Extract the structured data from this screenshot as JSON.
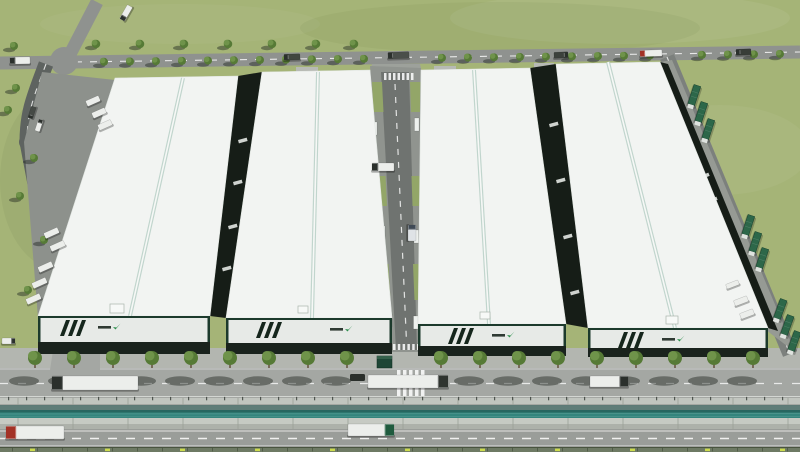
{
  "meta": {
    "description": "Aerial 3D rendering of an industrial park: four white-roofed warehouses in a row, central service corridor, perimeter roads with trucks and trees, front canal and outer highway"
  },
  "palette": {
    "grass": "#a5b477",
    "roadTop": "#8f928f",
    "roadLeft": "#5e6360",
    "roadRight": "#7c807d",
    "roadCorridor": "#6f7370",
    "apron": "#b3b6b0",
    "innerRoad": "#a4a7a3",
    "outerRoad": "#9a9d99",
    "pad": "#b7bab4",
    "campusApron": "#8d918c",
    "rightApron": "#969a94",
    "wallTop": "#c1c5bf",
    "wallShadow": "#5f7d78",
    "water": "#33857d",
    "waterDark": "#276660",
    "nearWall": "#c6cac3",
    "wallFace": "#adb1aa",
    "hedge": "#6e7a64",
    "hedgeDot": "#ccdb4e",
    "roof": "#f2f4f2",
    "roofEdge": "#e0e5e1",
    "ridge": "#bcd2ca",
    "facade": "#e7eae7",
    "facadeBase": "#1a231d",
    "accent": "#1c3a2c",
    "stripe": "#15261c",
    "gapDark": "#161d17",
    "corridorGrass": "#93a668",
    "treeCrown": "#567a36",
    "treeLight": "#6f934a",
    "trunk": "#5d4a33",
    "truckWhite": "#eceeeb",
    "cabDark": "#2b302c",
    "cabRed": "#a33226",
    "cabGreen": "#1f5b3e",
    "container": "#2d6749",
    "mark": "#2f8f4e",
    "shadow": "rgba(30,38,32,0.45)"
  },
  "scene": {
    "mottles": [
      [
        620,
        18,
        170,
        26,
        "rgba(255,255,255,0.06)"
      ],
      [
        180,
        24,
        140,
        20,
        "rgba(255,255,255,0.04)"
      ],
      [
        500,
        28,
        200,
        26,
        "rgba(110,125,70,0.10)"
      ],
      [
        720,
        150,
        90,
        45,
        "rgba(255,255,255,0.05)"
      ],
      [
        60,
        180,
        60,
        90,
        "rgba(45,65,30,0.06)"
      ]
    ],
    "bands": [
      {
        "name": "front-apron",
        "y": 348,
        "h": 20,
        "c": "$apron"
      },
      {
        "name": "inner-road",
        "y": 368,
        "h": 30,
        "c": "$innerRoad"
      },
      {
        "name": "canal-wall-top",
        "y": 398,
        "h": 7,
        "c": "$wallTop"
      },
      {
        "name": "canal-wall-shade",
        "y": 405,
        "h": 5,
        "c": "$wallShadow"
      },
      {
        "name": "canal-water",
        "y": 410,
        "h": 8,
        "c": "$water"
      },
      {
        "name": "canal-near-wall",
        "y": 418,
        "h": 6,
        "c": "$nearWall"
      },
      {
        "name": "canal-wall-face",
        "y": 424,
        "h": 5,
        "c": "$wallFace"
      },
      {
        "name": "outer-road",
        "y": 429,
        "h": 18,
        "c": "$outerRoad"
      },
      {
        "name": "perimeter-hedge",
        "y": 447,
        "h": 5,
        "c": "$hedge"
      }
    ],
    "lane_marks": [
      {
        "y": 369,
        "dash": "",
        "w": 1,
        "c": "#ffffff",
        "o": 0.45
      },
      {
        "y": 383.5,
        "dash": "8 10",
        "w": 1.3,
        "c": "#ffffff",
        "o": 0.75
      },
      {
        "y": 396.5,
        "dash": "",
        "w": 1,
        "c": "#e8ebe7",
        "o": 0.7
      },
      {
        "y": 431,
        "dash": "",
        "w": 1,
        "c": "#ffffff",
        "o": 0.7
      },
      {
        "y": 438.5,
        "dash": "9 9",
        "w": 1.4,
        "c": "#ffffff",
        "o": 0.85
      },
      {
        "y": 445.7,
        "dash": "",
        "w": 0.8,
        "c": "#ffffff",
        "o": 0.45
      }
    ],
    "roads": {
      "top": {
        "d": "M0,63 L800,52",
        "w": 13,
        "c": "$roadTop",
        "dash": "7 8"
      },
      "top_arm": {
        "d": "M97,2 L67,60",
        "w": 13,
        "c": "$roadTop",
        "dash": ""
      },
      "left_arm": {
        "d": "M0,64 L62,62",
        "w": 11,
        "c": "$roadTop",
        "dash": ""
      },
      "left": {
        "d": "M46,64 C34,96 27,112 27,142 L66,346",
        "w": 15,
        "c": "$roadLeft",
        "dash": "6 7"
      },
      "right": {
        "d": "M667,57 L790,354",
        "w": 15,
        "c": "$roadRight",
        "dash": "6 7"
      },
      "intersection": [
        64,
        61,
        14
      ]
    },
    "aprons": [
      {
        "name": "warehouse-1-west-apron",
        "pts": "42,72 115,80 38,318 24,142",
        "c": "$campusApron"
      },
      {
        "name": "warehouse-4-east-apron",
        "pts": "660,62 672,60 795,352 766,330",
        "c": "$rightApron"
      },
      {
        "name": "corridor-top-apron",
        "pts": "372,64 420,64 424,82 368,82",
        "c": "#9da19b"
      },
      {
        "name": "left-junction-pad",
        "pts": "54,344 100,344 100,370 50,370",
        "c": "$innerRoad"
      }
    ],
    "pads": [
      [
        296,
        67,
        22,
        8
      ],
      [
        434,
        66,
        22,
        8
      ],
      [
        534,
        63,
        20,
        9
      ],
      [
        600,
        66,
        36,
        10
      ]
    ],
    "corridor": {
      "apron": "370,66 421,68 418,352 392,352",
      "road": "381,72 409,72 417,350 396,350",
      "grass": [
        "372,82 382,82 383.5,112 373.5,112",
        "410,82 420.3,82 419.9,112 411,112",
        "375.5,176 385.5,176 387,206 377,206",
        "411.5,176 420,176 419.8,206 412.5,206",
        "379,264 388.5,264 390.5,300 381.5,300",
        "413,264 419.7,264 419.5,300 414.5,300"
      ],
      "dash": [
        395,
        84,
        406.5,
        342
      ],
      "canopies": [
        [
          372.5,
          122
        ],
        [
          380.5,
          226
        ],
        [
          387.5,
          314
        ],
        [
          414.5,
          118
        ],
        [
          414,
          230
        ],
        [
          413.5,
          316
        ]
      ],
      "zebra_top": {
        "x": 384,
        "y": 73,
        "n": 7,
        "dx": 4.5,
        "w": 2.5,
        "h": 7
      },
      "zebra_bottom": {
        "x": 393,
        "y": 344,
        "n": 6,
        "dx": 4.8,
        "w": 2.5,
        "h": 6
      }
    },
    "gaps": [
      {
        "name": "dock-strip-1-2",
        "pts": "210,316 226,318 262,72 238,76",
        "rot": -15,
        "slivers": [
          [
            238,
            140
          ],
          [
            233,
            182
          ],
          [
            228,
            226
          ],
          [
            222,
            268
          ]
        ]
      },
      {
        "name": "dock-strip-3-4",
        "pts": "566,324 588,328 556,64 530,68",
        "rot": -15,
        "slivers": [
          [
            549,
            124
          ],
          [
            556,
            180
          ],
          [
            563,
            236
          ],
          [
            570,
            292
          ]
        ]
      },
      {
        "name": "dock-strip-4-east",
        "pts": "768,328 778,331 668,64 660,62",
        "rot": -22,
        "slivers": [
          [
            700,
            176
          ],
          [
            708,
            200
          ],
          [
            736,
            298
          ],
          [
            743,
            312
          ]
        ]
      }
    ],
    "buildings": [
      {
        "id": "warehouse-1",
        "roof": "38,316 210,316 238,76 115,78",
        "ridge": [
          130,
          316,
          183,
          78
        ],
        "facade": {
          "x": 38,
          "y": 316,
          "w": 172,
          "h": 28
        },
        "base_h": 10,
        "stripes_x": 60,
        "logo_x": 98,
        "unit": [
          110,
          304,
          14,
          9
        ]
      },
      {
        "id": "warehouse-2",
        "roof": "226,318 392,318 370,70 262,72",
        "ridge": [
          312,
          318,
          318,
          72
        ],
        "facade": {
          "x": 226,
          "y": 318,
          "w": 166,
          "h": 27
        },
        "base_h": 9,
        "stripes_x": 256,
        "logo_x": 330,
        "unit": [
          298,
          306,
          10,
          7
        ]
      },
      {
        "id": "warehouse-3",
        "roof": "418,324 566,324 530,68 421,70",
        "ridge": [
          489,
          324,
          474,
          70
        ],
        "facade": {
          "x": 418,
          "y": 324,
          "w": 148,
          "h": 24
        },
        "base_h": 8,
        "stripes_x": 448,
        "logo_x": 492,
        "unit": [
          480,
          312,
          10,
          7
        ]
      },
      {
        "id": "warehouse-4",
        "roof": "588,328 768,328 660,62 556,64",
        "ridge": [
          675,
          328,
          608,
          62
        ],
        "facade": {
          "x": 588,
          "y": 328,
          "w": 180,
          "h": 22
        },
        "base_h": 7,
        "stripes_x": 618,
        "logo_x": 662,
        "unit": [
          666,
          316,
          12,
          8
        ]
      }
    ],
    "gate": {
      "house": [
        377,
        356,
        15,
        12
      ],
      "car": [
        350,
        374,
        15,
        7
      ],
      "zebra": {
        "x": 397,
        "y": 370,
        "n": 5,
        "dx": 6,
        "w": 3.5,
        "h": 26
      }
    },
    "trees": {
      "front": {
        "y": 358,
        "s": 1.4,
        "xs": [
          35,
          74,
          113,
          152,
          191,
          230,
          269,
          308,
          347,
          441,
          480,
          519,
          558,
          597,
          636,
          675,
          714,
          753
        ]
      },
      "top_lower": {
        "from": 104,
        "to": 792,
        "step": 26,
        "y0": 63,
        "slope": -0.0115,
        "s": 0.8,
        "skip": [
          [
            366,
            438
          ],
          [
            654,
            688
          ]
        ]
      },
      "top_upper": {
        "y": 44,
        "s": 0.85,
        "xs": [
          96,
          140,
          184,
          228,
          272,
          316,
          354
        ]
      },
      "left_scatter": {
        "s": 0.8,
        "pts": [
          [
            14,
            46
          ],
          [
            16,
            88
          ],
          [
            8,
            110
          ],
          [
            34,
            158
          ],
          [
            20,
            196
          ],
          [
            44,
            240
          ],
          [
            28,
            290
          ]
        ]
      }
    },
    "trucks": [
      [
        10,
        57,
        20,
        7,
        -1,
        "L",
        "$cabDark",
        "$truckWhite"
      ],
      [
        118,
        10,
        16,
        6,
        -60,
        "L",
        "$cabDark",
        "$truckWhite"
      ],
      [
        284,
        54,
        16,
        6,
        -2,
        "L",
        "$cabDark",
        "#41463f"
      ],
      [
        388,
        52,
        21,
        6.5,
        -2,
        "L",
        "$cabDark",
        "#4a4f4a"
      ],
      [
        554,
        52,
        14,
        6,
        -2,
        "R",
        "$cabDark",
        "#3c413c"
      ],
      [
        640,
        50,
        22,
        6.5,
        -2,
        "L",
        "$cabRed",
        "$truckWhite"
      ],
      [
        736,
        49,
        15,
        6,
        -2,
        "L",
        "$cabDark",
        "#383d38"
      ],
      [
        26,
        110,
        12,
        5,
        -72,
        "L",
        "$cabDark",
        "#454a45"
      ],
      [
        33,
        123,
        12,
        5,
        -72,
        "R",
        "$cabDark",
        "$truckWhite"
      ],
      [
        2,
        338,
        13,
        6,
        0,
        "R",
        "$cabDark",
        "$truckWhite"
      ],
      [
        86,
        98,
        14,
        6,
        -24,
        "N",
        "",
        "$truckWhite"
      ],
      [
        92,
        110,
        14,
        6,
        -24,
        "N",
        "",
        "$truckWhite"
      ],
      [
        98,
        122,
        14,
        6,
        -24,
        "N",
        "",
        "$truckWhite"
      ],
      [
        44,
        230,
        15,
        6,
        -24,
        "N",
        "",
        "$truckWhite"
      ],
      [
        50,
        243,
        15,
        6,
        -24,
        "N",
        "",
        "$truckWhite"
      ],
      [
        38,
        264,
        15,
        6,
        -24,
        "N",
        "",
        "$truckWhite"
      ],
      [
        32,
        280,
        15,
        6,
        -24,
        "N",
        "",
        "$truckWhite"
      ],
      [
        26,
        296,
        15,
        6,
        -24,
        "N",
        "",
        "$truckWhite"
      ],
      [
        372,
        163,
        22,
        8,
        0,
        "L",
        "$cabDark",
        "$truckWhite"
      ],
      [
        404,
        229,
        16,
        8,
        90,
        "L",
        "#3f4a55",
        "#dfe3e6"
      ],
      [
        52,
        376,
        86,
        14,
        0,
        "L",
        "$cabDark",
        "$truckWhite"
      ],
      [
        368,
        375,
        80,
        13,
        0,
        "R",
        "#2f342f",
        "$truckWhite"
      ],
      [
        590,
        376,
        38,
        11,
        0,
        "R",
        "$cabDark",
        "$truckWhite"
      ],
      [
        6,
        426,
        58,
        13,
        0,
        "L",
        "$cabRed",
        "$truckWhite"
      ],
      [
        348,
        424,
        46,
        12,
        0,
        "R",
        "$cabGreen",
        "$truckWhite"
      ],
      [
        734,
        298,
        14,
        6,
        -21,
        "N",
        "",
        "$truckWhite"
      ],
      [
        740,
        311,
        14,
        6,
        -21,
        "N",
        "",
        "$truckWhite"
      ],
      [
        726,
        282,
        13,
        5,
        -21,
        "N",
        "",
        "$truckWhite"
      ]
    ],
    "containers": [
      [
        694,
        96,
        18
      ],
      [
        701,
        113,
        18
      ],
      [
        708,
        130,
        18
      ],
      [
        748,
        226,
        18
      ],
      [
        755,
        243,
        18
      ],
      [
        762,
        259,
        18
      ],
      [
        780,
        310,
        20
      ],
      [
        787,
        326,
        20
      ],
      [
        794,
        342,
        20
      ]
    ],
    "hedge_dots": {
      "from": 30,
      "step": 75,
      "w": 5,
      "h": 2.5
    },
    "wall_joints": {
      "from": 18,
      "step": 55
    },
    "wall_posts": {
      "from": 8,
      "step": 18
    }
  }
}
